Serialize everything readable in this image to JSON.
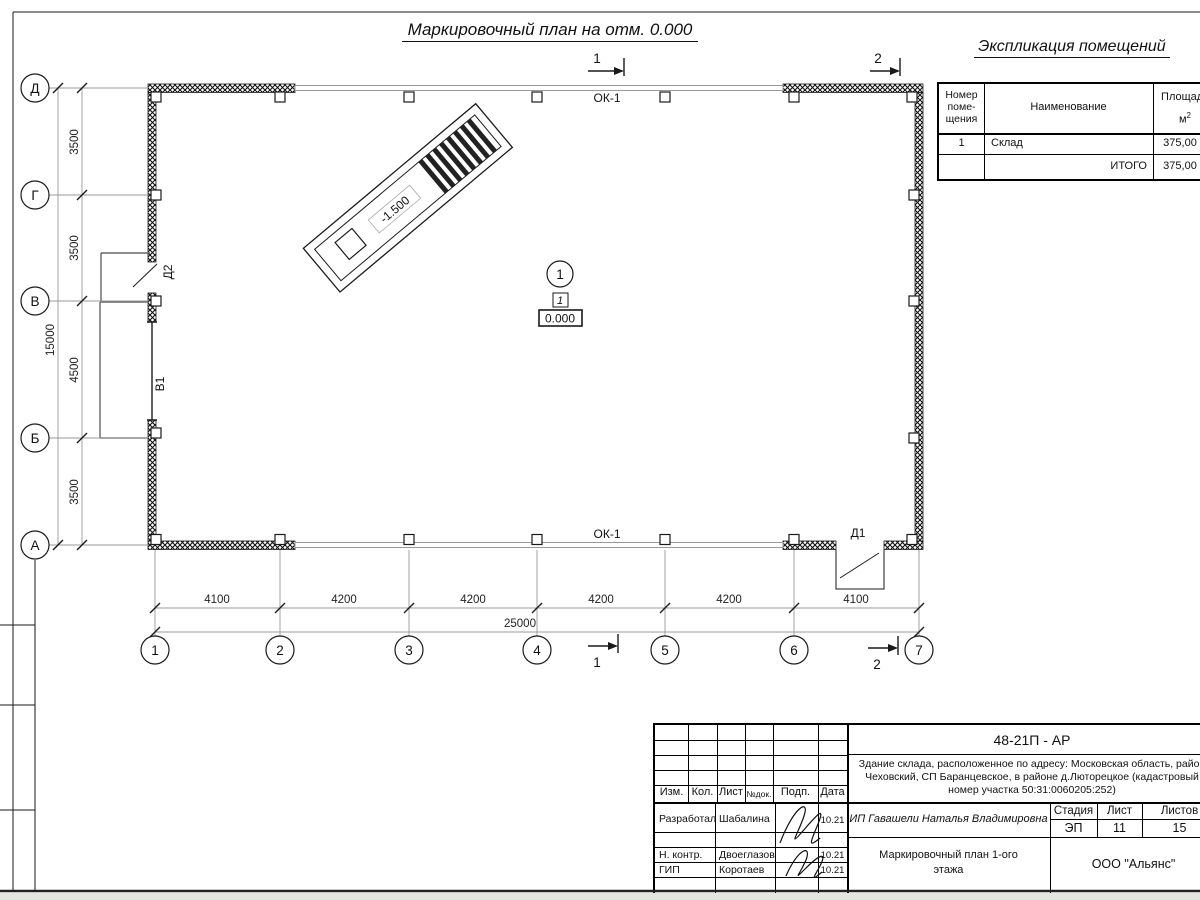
{
  "title": "Маркировочный план на отм. 0.000",
  "explication": {
    "title": "Экспликация помещений",
    "columns": {
      "number": [
        "Номер",
        "поме-",
        "щения"
      ],
      "name": "Наименование",
      "area": "Площадь",
      "area_unit": "м",
      "area_sup": "2"
    },
    "rows": [
      {
        "num": "1",
        "name": "Склад",
        "area": "375,00"
      },
      {
        "num": "",
        "name": "ИТОГО",
        "area": "375,00"
      }
    ]
  },
  "plan": {
    "window_top": "ОК-1",
    "window_bottom": "ОК-1",
    "door_d1": "Д1",
    "door_d2": "Д2",
    "gate_v1": "В1",
    "ramp_level": "-1.500",
    "room_circle": "1",
    "room_tag": "1",
    "floor_level": "0.000",
    "section_1": "1",
    "section_2": "2"
  },
  "axes": {
    "vertical": [
      "Д",
      "Г",
      "В",
      "Б",
      "А"
    ],
    "horizontal": [
      "1",
      "2",
      "3",
      "4",
      "5",
      "6",
      "7"
    ]
  },
  "dimensions": {
    "vertical": [
      "3500",
      "3500",
      "4500",
      "3500"
    ],
    "vertical_total": "15000",
    "horizontal": [
      "4100",
      "4200",
      "4200",
      "4200",
      "4200",
      "4100"
    ],
    "horizontal_total": "25000"
  },
  "titleblock": {
    "doc_code": "48-21П - АР",
    "description": [
      "Здание склада, расположенное по адресу: Московская область, район",
      "Чеховский, СП Баранцевское, в районе д.Люторецкое  (кадастровый",
      "номер участка 50:31:0060205:252)"
    ],
    "header_cells": [
      "Изм.",
      "Кол.",
      "Лист",
      "№док.",
      "Подп.",
      "Дата"
    ],
    "rows": [
      {
        "role": "Разработал",
        "name": "Шабалина",
        "date": "10.21"
      },
      {
        "role": "Н. контр.",
        "name": "Двоеглазов",
        "date": "10.21"
      },
      {
        "role": "ГИП",
        "name": "Коротаев",
        "date": "10.21"
      }
    ],
    "client": "ИП Гавашели Наталья Владимировна",
    "stage_label": "Стадия",
    "sheet_label": "Лист",
    "sheets_label": "Листов",
    "stage": "ЭП",
    "sheet": "11",
    "sheets": "15",
    "drawing_title": [
      "Маркировочный план 1-ого",
      "этажа"
    ],
    "company": "ООО \"Альянс\""
  }
}
